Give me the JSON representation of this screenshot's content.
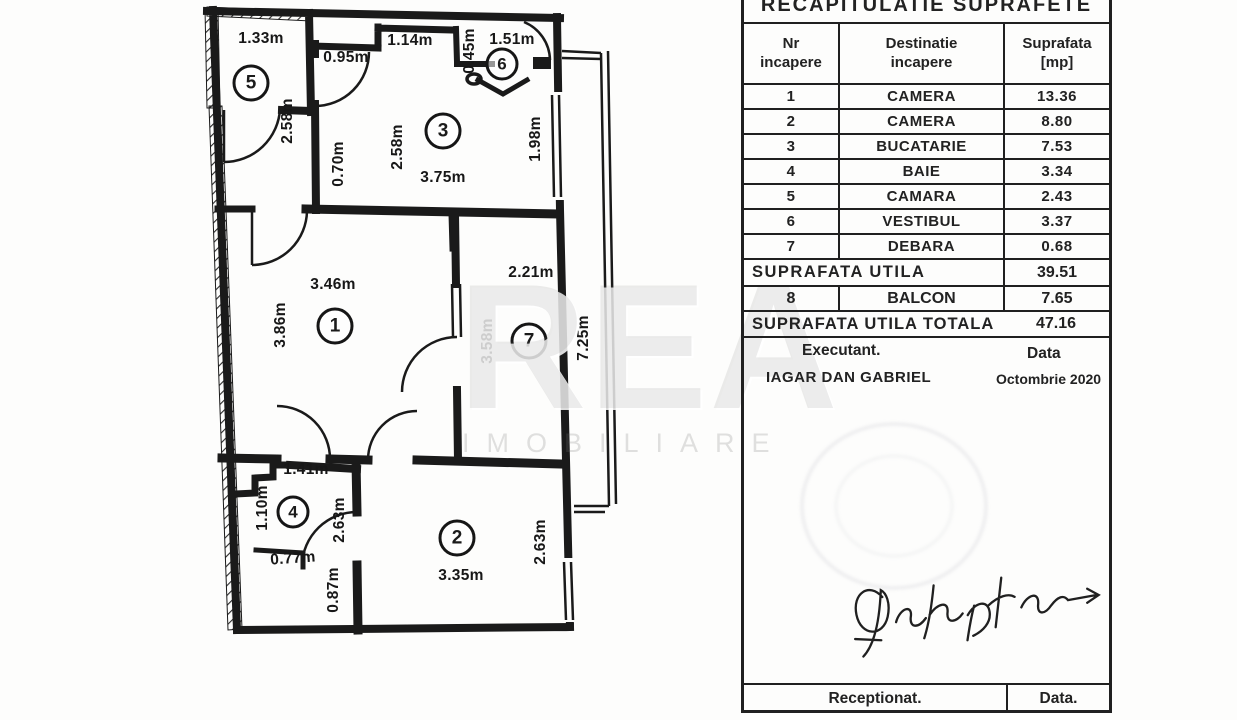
{
  "plan": {
    "circles": {
      "c1": "1",
      "c2": "2",
      "c3": "3",
      "c4": "4",
      "c5": "5",
      "c6": "6",
      "c7": "7"
    },
    "labels": {
      "r5_top": "1.33m",
      "r5_right": "2.58m",
      "r3_left_top": "0.95m",
      "r3_mid_top": "1.14m",
      "r3_left": "2.58m",
      "r3_door": "0.70m",
      "r3_bottom": "3.75m",
      "r3_window": "1.98m",
      "r6_top": "1.51m",
      "r6_left": "0.45m",
      "r1_top": "3.46m",
      "r1_left": "3.86m",
      "r7_top": "2.21m",
      "r7_left": "3.58m",
      "balcony_len": "7.25m",
      "r2_right": "2.63m",
      "r2_bottom": "3.35m",
      "r4_top": "1.41m",
      "r4_left": "1.10m",
      "r4_step": "0.77m",
      "r4_right": "2.63m",
      "r4_bottom": "0.87m"
    }
  },
  "watermark": {
    "main": "REA",
    "sub": "IMOBILIARE"
  },
  "table": {
    "title": "RECAPITULATIE  SUPRAFETE",
    "columns": [
      {
        "l1": "Nr",
        "l2": "incapere"
      },
      {
        "l1": "Destinatie",
        "l2": "incapere"
      },
      {
        "l1": "Suprafata",
        "l2": "[mp]"
      }
    ],
    "rows": [
      [
        "1",
        "CAMERA",
        "13.36"
      ],
      [
        "2",
        "CAMERA",
        "8.80"
      ],
      [
        "3",
        "BUCATARIE",
        "7.53"
      ],
      [
        "4",
        "BAIE",
        "3.34"
      ],
      [
        "5",
        "CAMARA",
        "2.43"
      ],
      [
        "6",
        "VESTIBUL",
        "3.37"
      ],
      [
        "7",
        "DEBARA",
        "0.68"
      ]
    ],
    "utila": {
      "label": "SUPRAFATA  UTILA",
      "value": "39.51"
    },
    "balcon": [
      "8",
      "BALCON",
      "7.65"
    ],
    "total": {
      "label": "SUPRAFATA  UTILA  TOTALA",
      "value": "47.16"
    },
    "executant": {
      "label": "Executant.",
      "data_label": "Data",
      "name": "IAGAR DAN GABRIEL",
      "date": "Octombrie 2020"
    },
    "receptionat": {
      "label": "Receptionat.",
      "data_label": "Data."
    }
  }
}
